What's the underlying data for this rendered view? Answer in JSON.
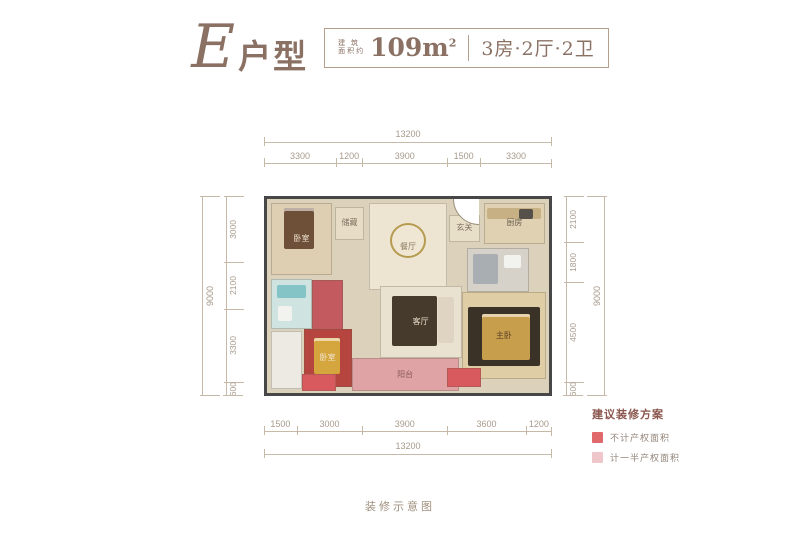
{
  "header": {
    "type_name": "E",
    "type_word": "户型",
    "area_prefix_top": "建 筑",
    "area_prefix_bottom": "面积约",
    "area_value": "109m",
    "area_unit_sup": "2",
    "layout_spec": "3房·2厅·2卫"
  },
  "dimensions": {
    "top_total": "13200",
    "top_segments": [
      "3300",
      "1200",
      "3900",
      "1500",
      "3300"
    ],
    "bottom_segments": [
      "1500",
      "3000",
      "3900",
      "3600",
      "1200"
    ],
    "bottom_total": "13200",
    "left_total": "9000",
    "left_segments": [
      "3000",
      "2100",
      "3300",
      "600"
    ],
    "right_total": "9000",
    "right_segments": [
      "2100",
      "1800",
      "4500",
      "600"
    ]
  },
  "floor_plan": {
    "wall_color": "#474747",
    "floor_color": "#dcd1ba",
    "rooms": [
      {
        "name": "room-bedroom-2",
        "label": "卧室",
        "labelColor": "#f0e4d2",
        "x": 1.5,
        "y": 2,
        "w": 21.5,
        "h": 37,
        "bg": "#decfb3",
        "furniture": [
          {
            "type": "bed",
            "x": 20,
            "y": 6,
            "w": 52,
            "h": 58,
            "color": "#6e4f38"
          }
        ]
      },
      {
        "name": "room-storage",
        "label": "储藏",
        "x": 24,
        "y": 4,
        "w": 10.5,
        "h": 17,
        "bg": "#e7dcc5"
      },
      {
        "name": "room-dining",
        "label": "餐厅",
        "labelColor": "#8a7a60",
        "x": 36,
        "y": 2,
        "w": 28,
        "h": 45,
        "bg": "#ede5d2",
        "furniture": [
          {
            "type": "table",
            "x": 26,
            "y": 22,
            "w": 48,
            "h": 42,
            "color": "#efe7d3"
          }
        ]
      },
      {
        "name": "room-foyer",
        "label": "玄关",
        "x": 64.5,
        "y": 8,
        "w": 11,
        "h": 14,
        "bg": "#e8dfc8"
      },
      {
        "name": "room-kitchen",
        "label": "厨房",
        "labelColor": "#6d6050",
        "x": 77,
        "y": 2,
        "w": 21.5,
        "h": 21,
        "bg": "#dfd1b2",
        "furniture": [
          {
            "type": "counter",
            "x": 4,
            "y": 10,
            "w": 92,
            "h": 30,
            "color": "#c7b184"
          },
          {
            "type": "fixture",
            "x": 58,
            "y": 12,
            "w": 24,
            "h": 26,
            "color": "#55504a"
          }
        ]
      },
      {
        "name": "room-bathroom-2",
        "x": 71,
        "y": 25,
        "w": 22,
        "h": 23,
        "bg": "#d6d1c9",
        "furniture": [
          {
            "type": "fixture",
            "x": 8,
            "y": 14,
            "w": 42,
            "h": 70,
            "color": "#a9aeb3"
          },
          {
            "type": "fixture",
            "x": 60,
            "y": 16,
            "w": 28,
            "h": 30,
            "color": "#f2f3ef"
          }
        ]
      },
      {
        "name": "room-bathroom-1",
        "x": 1.5,
        "y": 41,
        "w": 14.5,
        "h": 26,
        "bg": "#cfe4e1",
        "furniture": [
          {
            "type": "fixture",
            "x": 12,
            "y": 12,
            "w": 74,
            "h": 26,
            "color": "#84c4c6"
          },
          {
            "type": "fixture",
            "x": 16,
            "y": 55,
            "w": 34,
            "h": 30,
            "color": "#f2f3ef"
          }
        ]
      },
      {
        "name": "room-shower",
        "x": 16,
        "y": 42,
        "w": 11,
        "h": 26,
        "bg": "#c25a60"
      },
      {
        "name": "room-living",
        "label": "客厅",
        "labelColor": "#e8dcc8",
        "x": 40,
        "y": 45,
        "w": 29,
        "h": 37,
        "bg": "#eae2d0",
        "furniture": [
          {
            "type": "rug",
            "x": 14,
            "y": 12,
            "w": 56,
            "h": 72,
            "color": "#463a2c"
          },
          {
            "type": "sofa",
            "x": 72,
            "y": 14,
            "w": 20,
            "h": 66,
            "color": "#ded4c1"
          }
        ]
      },
      {
        "name": "room-master-bedroom",
        "label": "主卧",
        "labelColor": "#5f4426",
        "x": 69,
        "y": 48,
        "w": 30,
        "h": 45,
        "bg": "#dfcda5",
        "furniture": [
          {
            "type": "rug",
            "x": 6,
            "y": 16,
            "w": 88,
            "h": 70,
            "color": "#3a3226"
          },
          {
            "type": "bed",
            "x": 24,
            "y": 24,
            "w": 58,
            "h": 54,
            "color": "#c79e4b"
          }
        ]
      },
      {
        "name": "room-bedroom-3",
        "label": "卧室",
        "labelColor": "#f0e4d2",
        "x": 13,
        "y": 67,
        "w": 17,
        "h": 30,
        "bg": "#b5453e",
        "furniture": [
          {
            "type": "bed",
            "x": 20,
            "y": 14,
            "w": 56,
            "h": 64,
            "color": "#d6a63e"
          }
        ]
      },
      {
        "name": "room-platform",
        "x": 1.5,
        "y": 68,
        "w": 11,
        "h": 30,
        "bg": "#eceae3"
      },
      {
        "name": "room-balcony",
        "label": "阳台",
        "labelColor": "#8a5a55",
        "x": 30,
        "y": 82,
        "w": 38,
        "h": 17,
        "bg": "#dfa3a6"
      },
      {
        "name": "room-ac-left",
        "x": 12.5,
        "y": 90,
        "w": 12,
        "h": 9,
        "bg": "#d8595e"
      },
      {
        "name": "room-ac-right",
        "x": 64,
        "y": 87,
        "w": 12,
        "h": 10,
        "bg": "#d8595e"
      }
    ]
  },
  "legend": {
    "title": "建议装修方案",
    "items": [
      {
        "label": "不计产权面积",
        "color": "#e0696b"
      },
      {
        "label": "计一半产权面积",
        "color": "#efc7ca"
      }
    ]
  },
  "footer": {
    "caption": "装修示意图"
  }
}
